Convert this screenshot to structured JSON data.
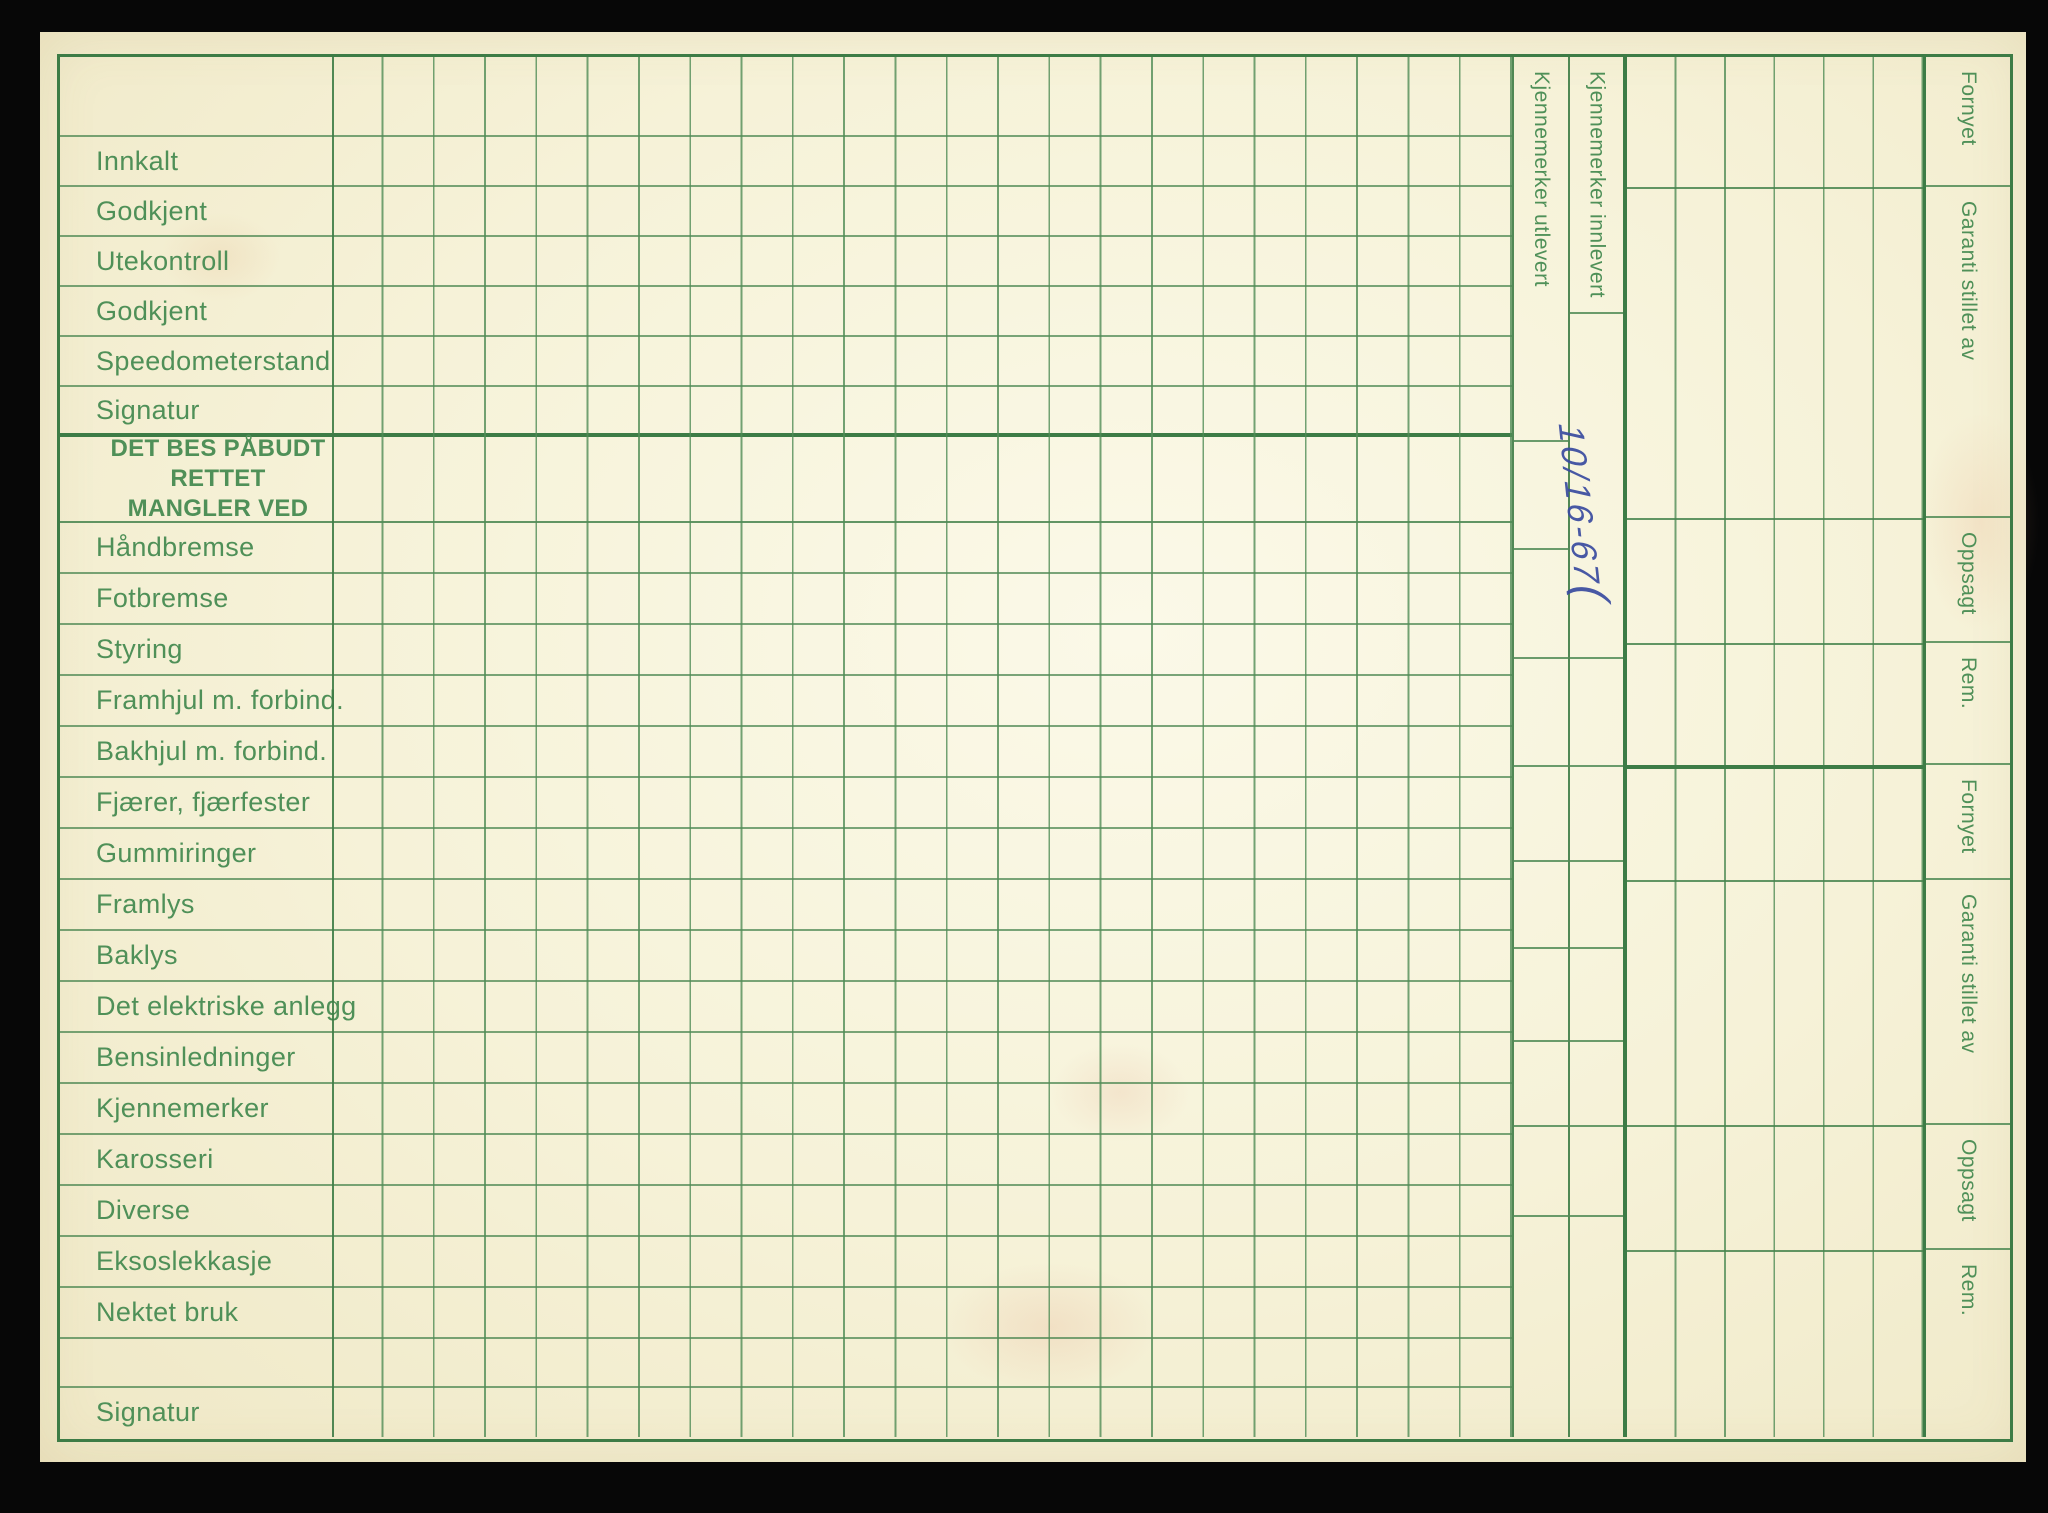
{
  "palette": {
    "paper": "#f6f2d8",
    "grid_green": "#4d8a55",
    "heavy_green": "#3d7c46",
    "label_green": "#4f9058",
    "handwriting_blue": "#3a4ba0",
    "background_black": "#070707"
  },
  "status_rows": {
    "r1": "Innkalt",
    "r2": "Godkjent",
    "r3": "Utekontroll",
    "r4": "Godkjent",
    "r5": "Speedometerstand",
    "r6": "Signatur"
  },
  "section_header": {
    "line1": "DET BES PÅBUDT RETTET",
    "line2": "MANGLER VED"
  },
  "defect_rows": {
    "r1": "Håndbremse",
    "r2": "Fotbremse",
    "r3": "Styring",
    "r4": "Framhjul m. forbind.",
    "r5": "Bakhjul m. forbind.",
    "r6": "Fjærer, fjærfester",
    "r7": "Gummiringer",
    "r8": "Framlys",
    "r9": "Baklys",
    "r10": "Det elektriske anlegg",
    "r11": "Bensinledninger",
    "r12": "Kjennemerker",
    "r13": "Karosseri",
    "r14": "Diverse",
    "r15": "Eksoslekkasje",
    "r16": "Nektet bruk"
  },
  "bottom_row": {
    "label": "Signatur"
  },
  "plate_columns": {
    "out": "Kjennemerker utlevert",
    "in": "Kjennemerker innlevert"
  },
  "handwriting": {
    "text": "10/16-67",
    "flourish": "("
  },
  "insurance_labels": {
    "s1": "Fornyet",
    "s2": "Garanti stillet av",
    "s3": "Oppsagt",
    "s4": "Rem.",
    "s5": "Fornyet",
    "s6": "Garanti stillet av",
    "s7": "Oppsagt",
    "s8": "Rem."
  }
}
